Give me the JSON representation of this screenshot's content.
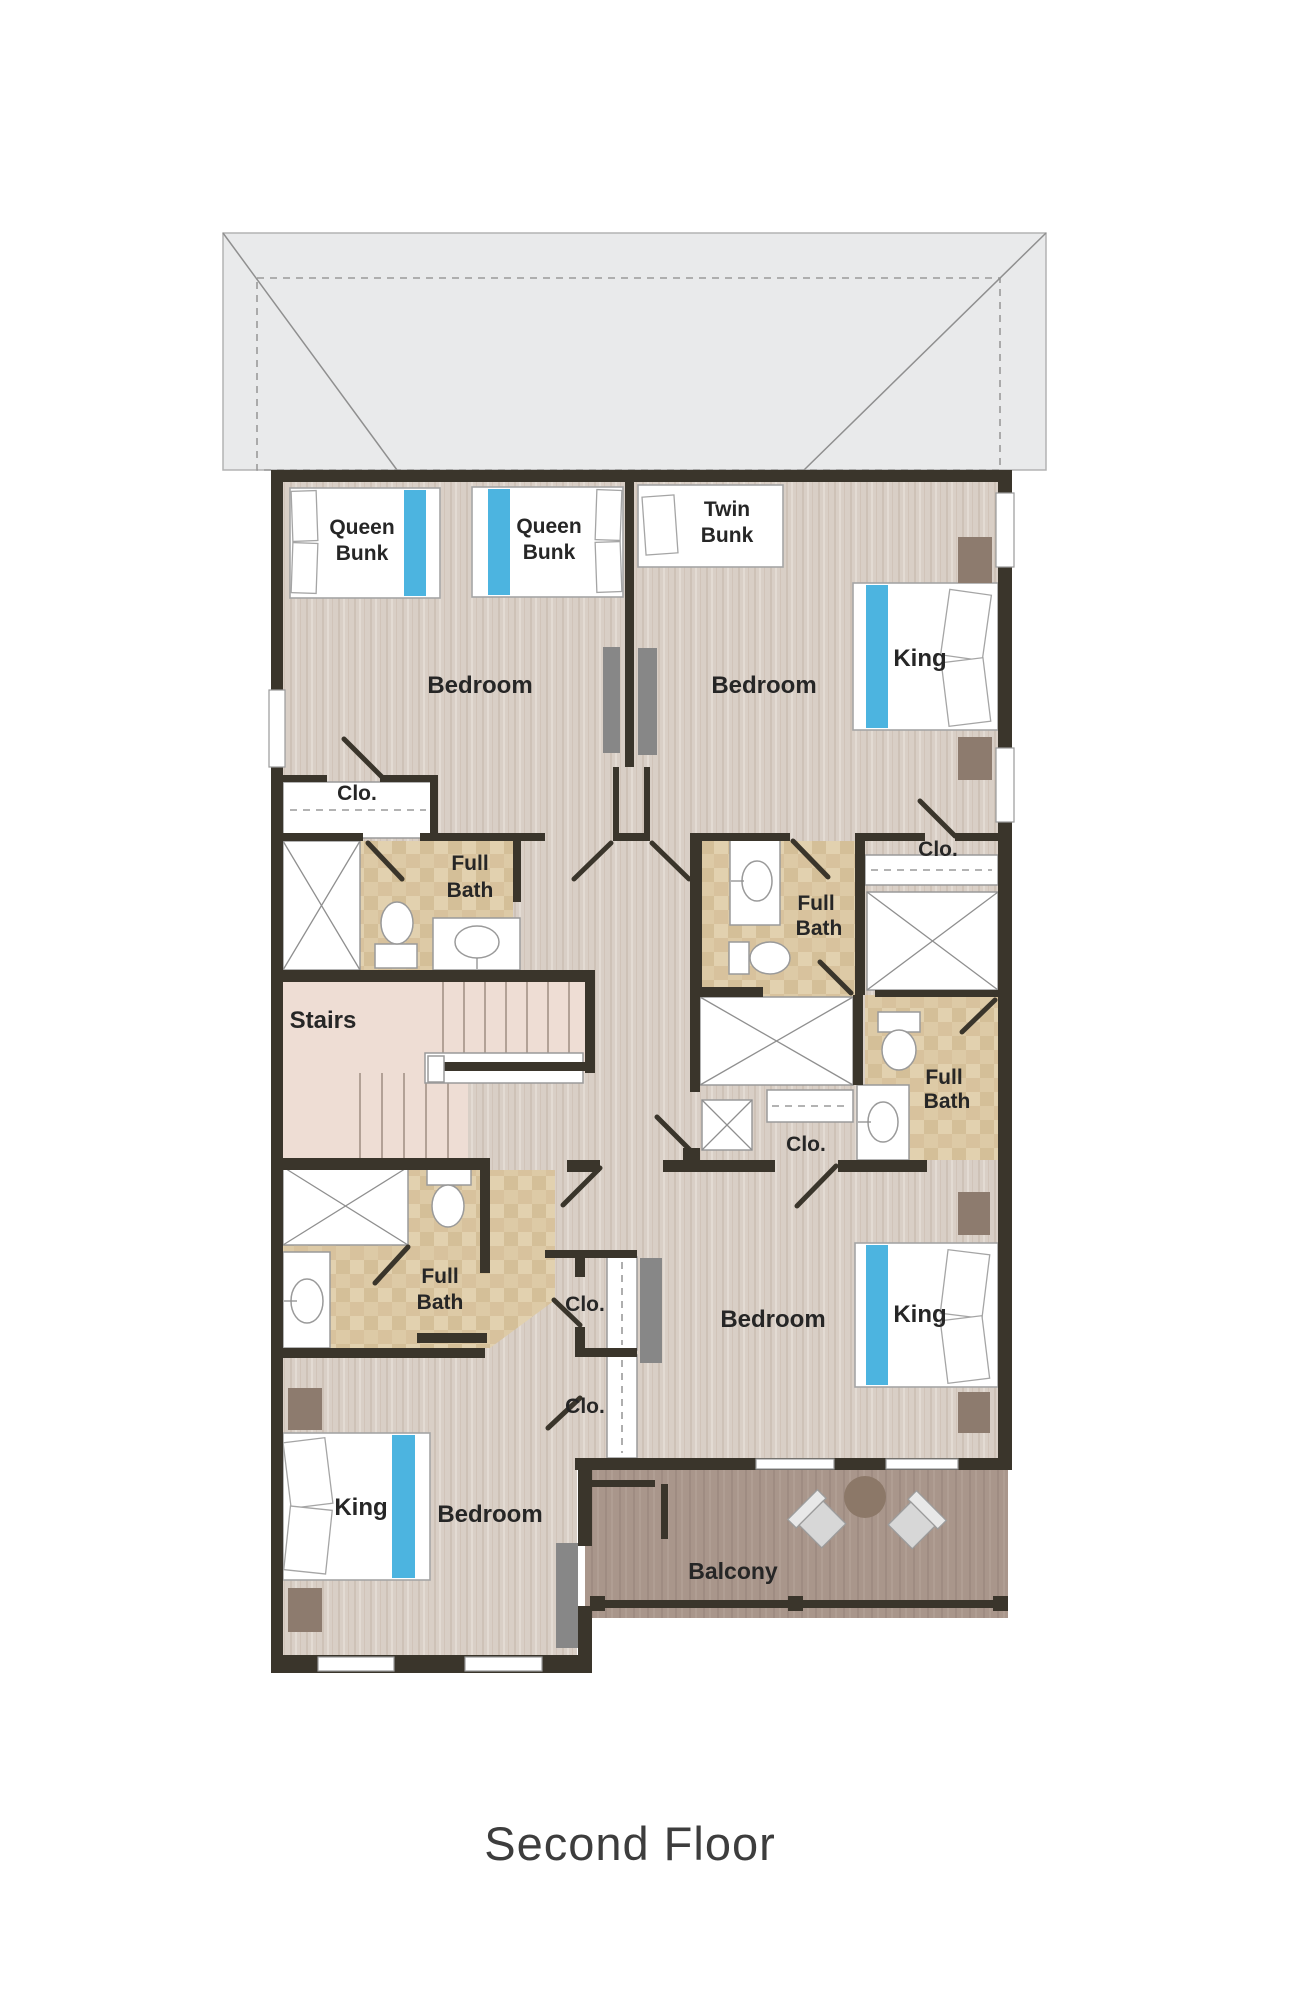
{
  "title": "Second Floor",
  "colors": {
    "wall": "#3a352b",
    "wood_floor": "#d9cfc6",
    "bath_floor": "#ddcaa6",
    "stairs_floor": "#eeddd4",
    "balcony_floor": "#a9968b",
    "roof_outer": "#e9eaeb",
    "roof_inner": "#d7d9da",
    "accent_blue": "#4cb4e0",
    "furniture_gray": "#878787",
    "furniture_taupe": "#8d7b6e",
    "label_text": "#262626",
    "title_text": "#3d3d3d"
  },
  "rooms": {
    "bedroom_upper_left": "Bedroom",
    "bedroom_upper_right": "Bedroom",
    "bedroom_lower_right": "Bedroom",
    "bedroom_lower_left": "Bedroom",
    "stairs": "Stairs",
    "balcony": "Balcony"
  },
  "baths": {
    "upper_left": {
      "line1": "Full",
      "line2": "Bath"
    },
    "upper_right": {
      "line1": "Full",
      "line2": "Bath"
    },
    "mid_right": {
      "line1": "Full",
      "line2": "Bath"
    },
    "lower_left": {
      "line1": "Full",
      "line2": "Bath"
    }
  },
  "closets": {
    "upper_left": "Clo.",
    "upper_right": "Clo.",
    "mid_right": "Clo.",
    "lower_1": "Clo.",
    "lower_2": "Clo."
  },
  "beds": {
    "queen_bunk_1": {
      "line1": "Queen",
      "line2": "Bunk"
    },
    "queen_bunk_2": {
      "line1": "Queen",
      "line2": "Bunk"
    },
    "twin_bunk": {
      "line1": "Twin",
      "line2": "Bunk"
    },
    "king_upper_right": "King",
    "king_lower_right": "King",
    "king_lower_left": "King"
  }
}
